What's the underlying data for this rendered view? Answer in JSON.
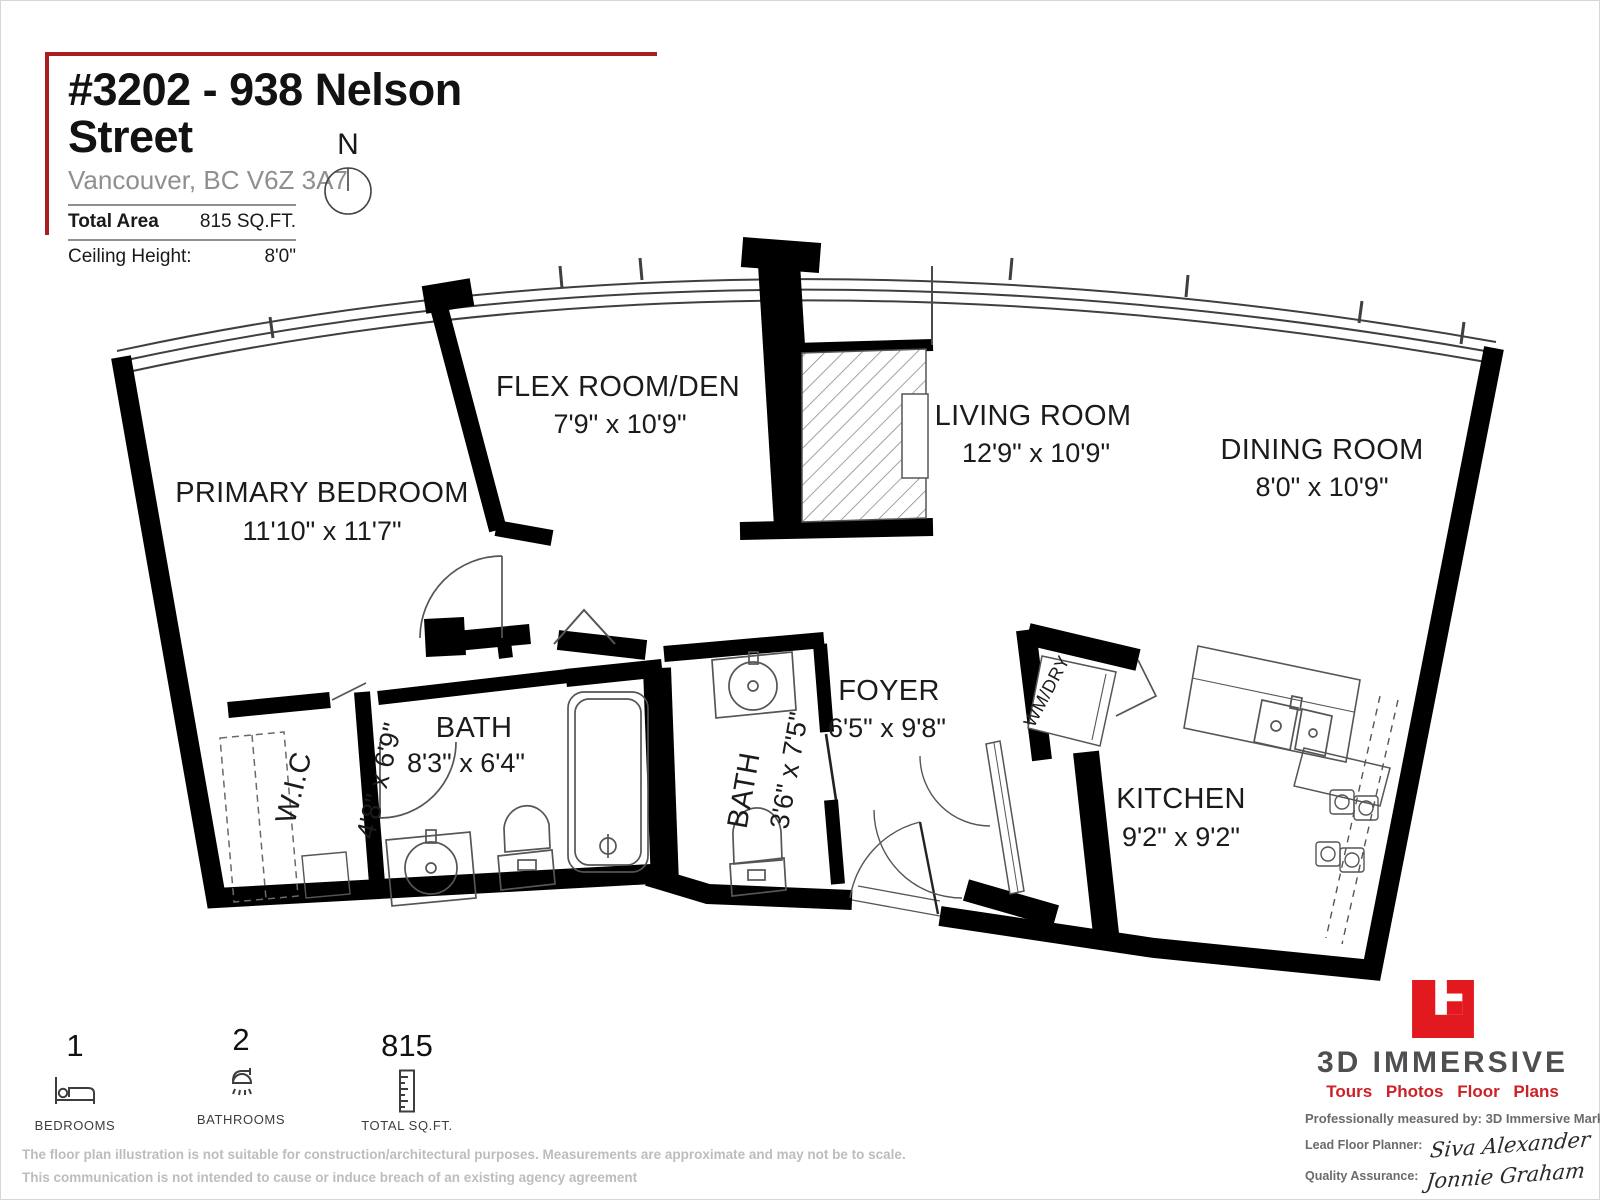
{
  "header": {
    "title": "#3202 - 938 Nelson Street",
    "address": "Vancouver, BC V6Z 3A7",
    "total_area_label": "Total Area",
    "total_area_value": "815 SQ.FT.",
    "ceiling_height_label": "Ceiling Height:",
    "ceiling_height_value": "8'0\"",
    "compass": "N"
  },
  "rooms": {
    "primary_bedroom": {
      "name": "PRIMARY BEDROOM",
      "dims": "11'10\" x 11'7\""
    },
    "flex_room": {
      "name": "FLEX ROOM/DEN",
      "dims": "7'9\" x 10'9\""
    },
    "living_room": {
      "name": "LIVING ROOM",
      "dims": "12'9\" x 10'9\""
    },
    "dining_room": {
      "name": "DINING ROOM",
      "dims": "8'0\" x 10'9\""
    },
    "foyer": {
      "name": "FOYER",
      "dims": "6'5\" x 9'8\""
    },
    "kitchen": {
      "name": "KITCHEN",
      "dims": "9'2\" x 9'2\""
    },
    "bath_main": {
      "name": "BATH",
      "dims": "8'3\" x 6'4\""
    },
    "bath_second": {
      "name": "BATH",
      "dims": "3'6\" x 7'5\""
    },
    "walk_in_closet": {
      "name": "W.I.C",
      "dims": "4'8\" x 6'9\""
    },
    "laundry": {
      "name": "WM/DRY"
    }
  },
  "stats": {
    "bedrooms": {
      "value": "1",
      "label": "BEDROOMS"
    },
    "bathrooms": {
      "value": "2",
      "label": "BATHROOMS"
    },
    "total_sqft": {
      "value": "815",
      "label": "TOTAL SQ.FT."
    }
  },
  "branding": {
    "company": "3D IMMERSIVE",
    "tagline": "Tours Photos Floor Plans",
    "measured_by": "Professionally measured by: 3D Immersive Marketing Ltd.",
    "lead_planner_label": "Lead Floor Planner:",
    "lead_planner_name": "Siva Alexander",
    "qa_label": "Quality Assurance:",
    "qa_name": "Jonnie Graham",
    "brand_red": "#e2191f",
    "brand_gray": "#4f4f51",
    "corner_red": "#a91e23"
  },
  "disclaimer": {
    "line1": "The floor plan illustration is not suitable for construction/architectural purposes. Measurements are approximate and may not be to scale.",
    "line2": "This communication is not intended to cause or induce breach of an existing agency agreement"
  }
}
